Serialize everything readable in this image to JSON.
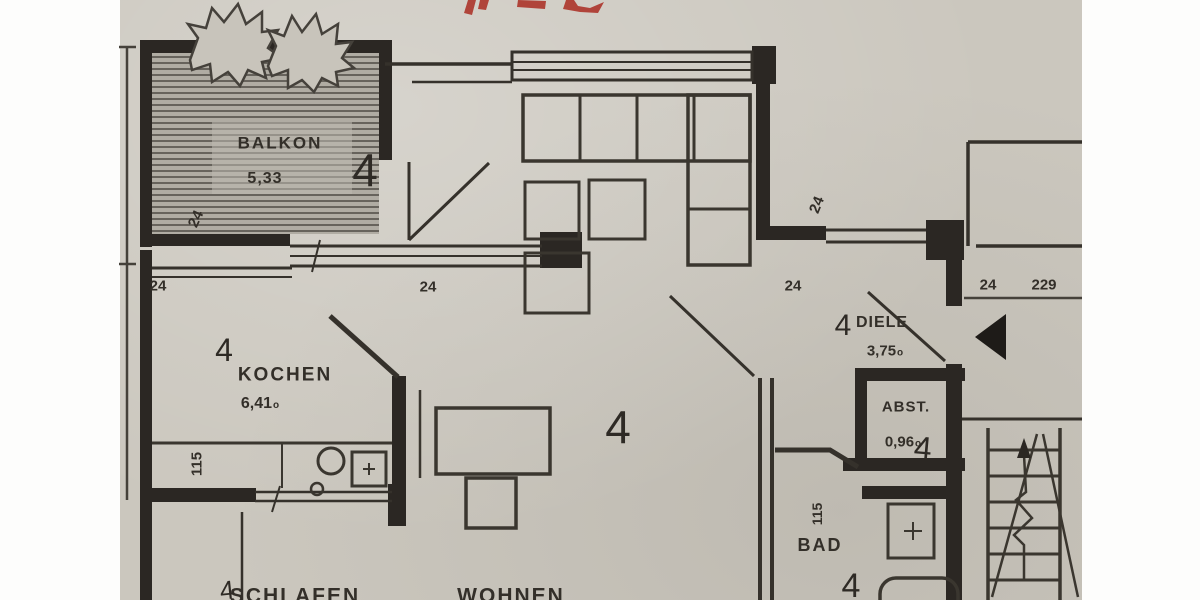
{
  "plan": {
    "rooms": {
      "balkon": {
        "name": "BALKON",
        "area": "5,33",
        "unit": "4",
        "dim_left": "24"
      },
      "kochen": {
        "name": "KOCHEN",
        "area": "6,41",
        "area_suffix": "o",
        "unit": "4",
        "dim_top_left": "24",
        "dim_top_right": "24",
        "dim_left": "115"
      },
      "wohnen": {
        "name": "WOHNEN",
        "unit": "4"
      },
      "schlafen": {
        "name": "SCHLAFEN",
        "unit": "4"
      },
      "diele": {
        "name": "DIELE",
        "area": "3,75",
        "area_suffix": "o",
        "unit": "4",
        "dim_top": "24",
        "dim_wall_left": "24",
        "dim_wall_right": "24",
        "dim_width": "229"
      },
      "abst": {
        "name": "ABST.",
        "area": "0,96",
        "area_suffix": "o",
        "unit": "4"
      },
      "bad": {
        "name": "BAD",
        "unit": "4",
        "dim_wall": "115"
      }
    },
    "colors": {
      "paper": "#cbc7be",
      "ink": "#2b2723",
      "red_mark": "#ad352b"
    }
  }
}
